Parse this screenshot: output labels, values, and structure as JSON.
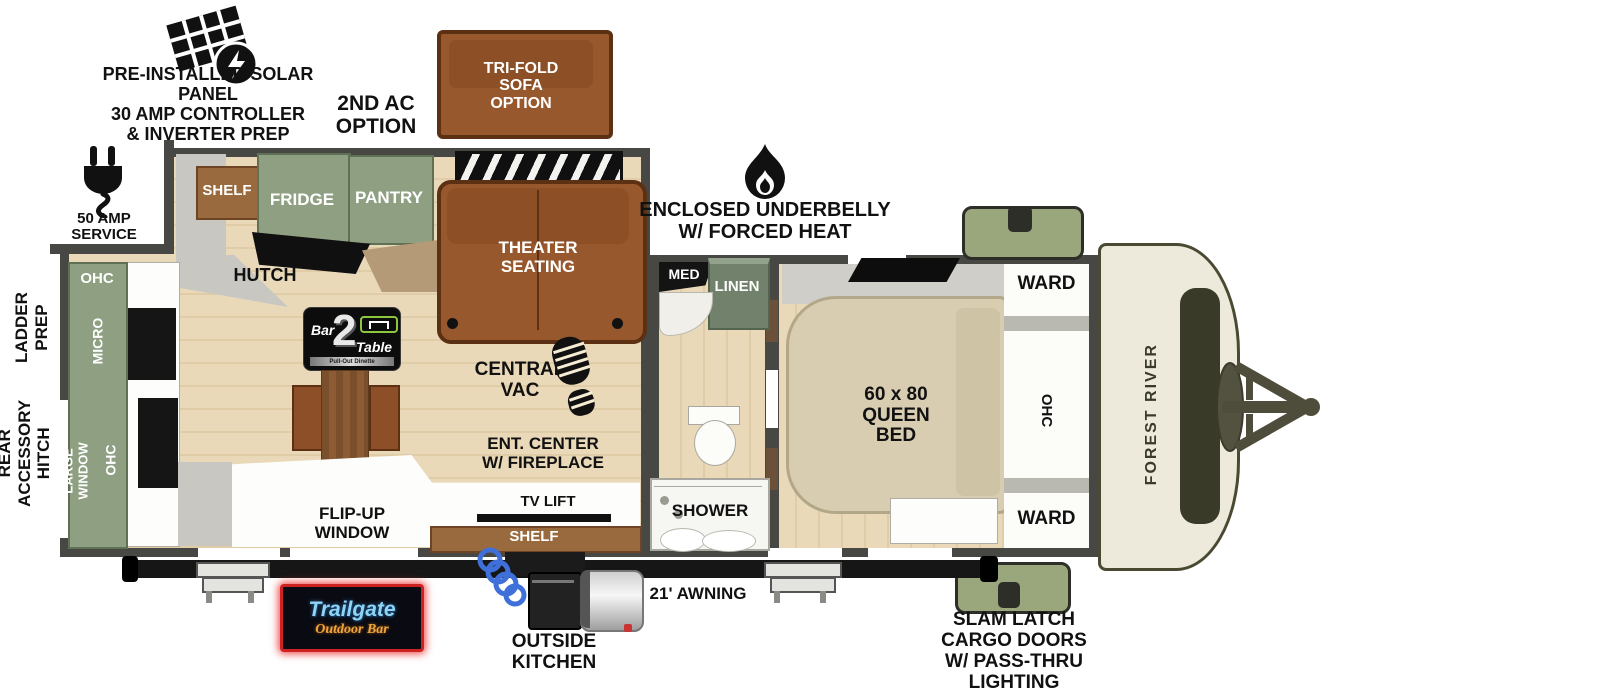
{
  "annotations": {
    "solar": "PRE-INSTALLED SOLAR PANEL\n30 AMP CONTROLLER\n& INVERTER PREP",
    "second_ac": "2ND AC\nOPTION",
    "tri_fold_sofa": "TRI-FOLD\nSOFA\nOPTION",
    "amp50": "50 AMP SERVICE",
    "ladder_prep": "LADDER\nPREP",
    "rear_accessory_hitch": "REAR\nACCESSORY\nHITCH",
    "underbelly": "ENCLOSED UNDERBELLY\nW/ FORCED HEAT",
    "awning": "21' AWNING",
    "outside_kitchen": "OUTSIDE\nKITCHEN",
    "slam_latch": "SLAM LATCH\nCARGO DOORS\nW/ PASS-THRU\nLIGHTING"
  },
  "interior": {
    "shelf_top": "SHELF",
    "fridge": "FRIDGE",
    "pantry": "PANTRY",
    "hutch": "HUTCH",
    "theater": "THEATER\nSEATING",
    "ohc_top": "OHC",
    "micro": "MICRO",
    "ohc_mid": "OHC",
    "large_window": "LARGE WINDOW",
    "central_vac": "CENTRAL\nVAC",
    "ent_center": "ENT. CENTER\nW/ FIREPLACE",
    "tv_lift": "TV LIFT",
    "shelf_bottom": "SHELF",
    "flip_up_window": "FLIP-UP\nWINDOW",
    "med": "MED",
    "linen": "LINEN",
    "shower": "SHOWER",
    "queen_bed": "60 x 80\nQUEEN\nBED",
    "ward_top": "WARD",
    "ohc_bedroom": "OHC",
    "ward_bottom": "WARD"
  },
  "logos": {
    "bar2table": {
      "bar": "Bar",
      "two": "2",
      "table": "Table",
      "tagline": "Pull-Out Dinette"
    },
    "trailgate": {
      "name": "Trailgate",
      "sub": "Outdoor Bar"
    },
    "forest_river": "FOREST RIVER"
  },
  "colors": {
    "wall": "#474744",
    "floor": "#ead9b9",
    "floor_line": "#e0cda8",
    "green": "#8e9f82",
    "green_dark": "#5f7055",
    "linen_green": "#72816b",
    "brown": "#9a6a3f",
    "brown_dark": "#6e4424",
    "sofa": "#98582d",
    "sofa_dark": "#5c3012",
    "bed": "#d9cdb1",
    "cream": "#eeeadb",
    "cap_border": "#4a4a33",
    "cargo": "#9aa77d",
    "gray": "#c8c7c1",
    "hose_blue": "#3f6fd8",
    "neon_blue": "#8fd4f7",
    "neon_orange": "#f0a63c",
    "hth_green": "#8dc63f"
  }
}
